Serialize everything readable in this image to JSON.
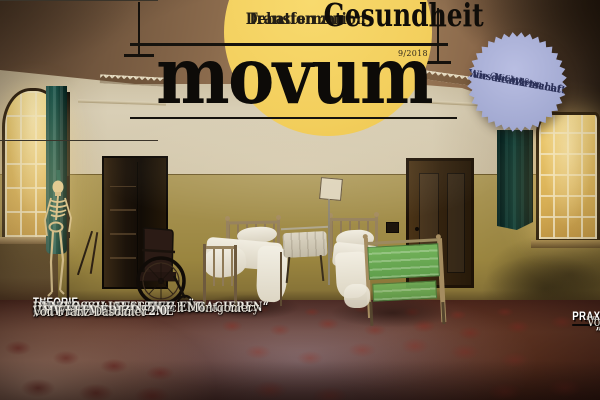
{
  "masthead": {
    "kicker_line1": "Debatten zur",
    "kicker_line2": "Transformation",
    "title": "movum",
    "issue_number": "9/2018",
    "cover_topic": "Gesundheit"
  },
  "badge": {
    "intro_line1": "Mit großem",
    "intro_line2": "Grafikposter:",
    "bold_line1": "Wie die Wirtschaft",
    "bold_line2": "uns krank macht"
  },
  "left_column": {
    "section_label": "THEORIE",
    "articles": [
      {
        "title_line1": "„ÄRZTE SOLLTEN SICH FÜR",
        "title_line2": "DEN FOSSIL-AUSSTIEG ENGAGIEREN“",
        "byline": "Interview mit Frank Ulrich Montgomery"
      },
      {
        "title_line1": "„WIR BRAUCHEN EINE",
        "title_line2": "UMWELTMEDIZIN 2.0“",
        "byline": "Von Franz Daschner"
      }
    ]
  },
  "right_column": {
    "section_label": "PRAXIS",
    "articles": [
      {
        "title_line1": "KRANKMACHER KOHLE",
        "byline": "Von Susanne Schwarz"
      },
      {
        "title_line1": "„EIN MUNDSCHUTZ",
        "title_line2": "BRINGT GAR NICHTS“",
        "byline": "Interview mit Alexandra Schneider"
      }
    ]
  },
  "colors": {
    "accent_yellow": "#f3cf5d",
    "badge_blue": "#a3aad2",
    "badge_text": "#2b3058",
    "curtain_teal": "#14504a",
    "bed_green": "#6fb158",
    "headline_white": "#f2efe8"
  }
}
